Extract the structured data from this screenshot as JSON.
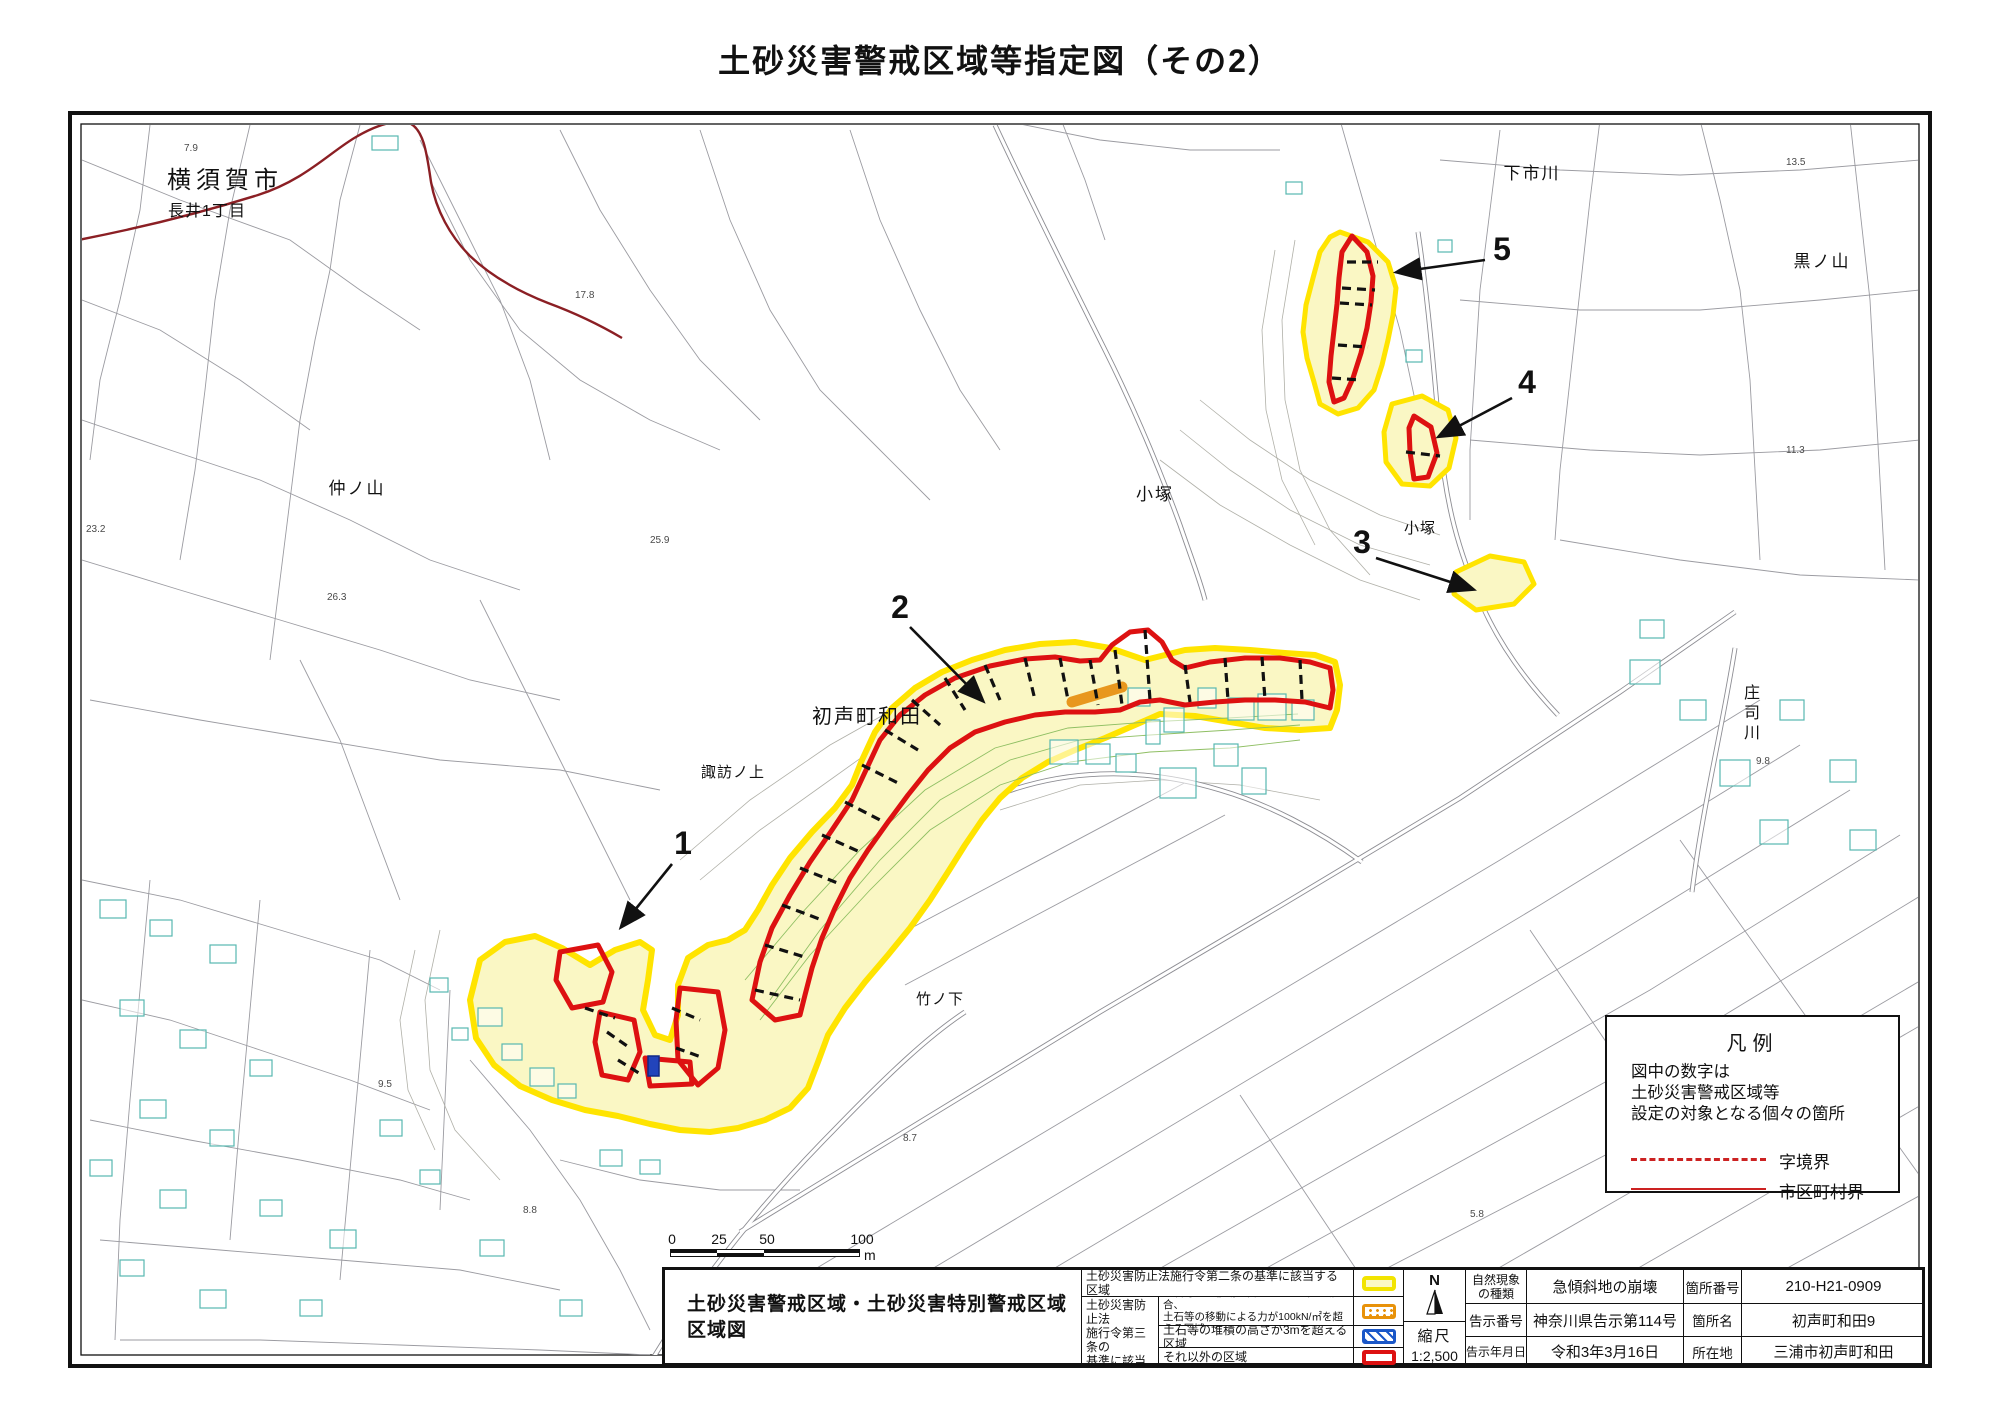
{
  "title": "土砂災害警戒区域等指定図（その2）",
  "map": {
    "labels": [
      {
        "text": "横須賀市",
        "x": 225,
        "y": 188,
        "size": 24,
        "ls": 5
      },
      {
        "text": "長井1丁目",
        "x": 207,
        "y": 216,
        "size": 16,
        "ls": 1
      },
      {
        "text": "仲ノ山",
        "x": 357,
        "y": 494,
        "size": 17,
        "ls": 2
      },
      {
        "text": "下市川",
        "x": 1532,
        "y": 179,
        "size": 17,
        "ls": 2
      },
      {
        "text": "黒ノ山",
        "x": 1822,
        "y": 267,
        "size": 17,
        "ls": 2
      },
      {
        "text": "小塚",
        "x": 1155,
        "y": 500,
        "size": 17,
        "ls": 2
      },
      {
        "text": "小塚",
        "x": 1420,
        "y": 533,
        "size": 15,
        "ls": 1
      },
      {
        "text": "庄司川",
        "x": 1752,
        "y": 698,
        "size": 16,
        "vertical": true
      },
      {
        "text": "初声町和田",
        "x": 867,
        "y": 723,
        "size": 20,
        "ls": 2
      },
      {
        "text": "諏訪ノ上",
        "x": 733,
        "y": 777,
        "size": 15,
        "ls": 1
      },
      {
        "text": "竹ノ下",
        "x": 940,
        "y": 1004,
        "size": 15,
        "ls": 1
      }
    ],
    "markers": [
      {
        "n": "1",
        "tx": 683,
        "ty": 854,
        "x1": 672,
        "y1": 864,
        "x2": 622,
        "y2": 926
      },
      {
        "n": "2",
        "tx": 900,
        "ty": 618,
        "x1": 910,
        "y1": 627,
        "x2": 982,
        "y2": 700
      },
      {
        "n": "3",
        "tx": 1362,
        "ty": 553,
        "x1": 1376,
        "y1": 558,
        "x2": 1472,
        "y2": 589
      },
      {
        "n": "4",
        "tx": 1527,
        "ty": 393,
        "x1": 1512,
        "y1": 398,
        "x2": 1440,
        "y2": 436
      },
      {
        "n": "5",
        "tx": 1502,
        "ty": 260,
        "x1": 1485,
        "y1": 260,
        "x2": 1398,
        "y2": 272
      }
    ],
    "elevations": [
      {
        "v": "7.9",
        "x": 184,
        "y": 151
      },
      {
        "v": "17.8",
        "x": 575,
        "y": 298
      },
      {
        "v": "23.2",
        "x": 86,
        "y": 532
      },
      {
        "v": "25.9",
        "x": 650,
        "y": 543
      },
      {
        "v": "26.3",
        "x": 327,
        "y": 600
      },
      {
        "v": "9.5",
        "x": 378,
        "y": 1087
      },
      {
        "v": "8.8",
        "x": 523,
        "y": 1213
      },
      {
        "v": "8.7",
        "x": 903,
        "y": 1141
      },
      {
        "v": "9.8",
        "x": 1756,
        "y": 764
      },
      {
        "v": "13.5",
        "x": 1786,
        "y": 165
      },
      {
        "v": "11.3",
        "x": 1786,
        "y": 453
      },
      {
        "v": "5.8",
        "x": 1470,
        "y": 1217
      }
    ],
    "colors": {
      "warning_zone_fill": "#faf7c4",
      "warning_zone_outline": "#ffe400",
      "special_zone_outline": "#dd1111",
      "debris_flow_force": "#e8971e",
      "debris_height": "#2244bb",
      "municipal_boundary": "#8b1f24",
      "building_outline": "#58b8b0"
    }
  },
  "legend_box": {
    "title": "凡例",
    "note_lines": [
      "図中の数字は",
      "土砂災害警戒区域等",
      "設定の対象となる個々の箇所"
    ],
    "items": [
      {
        "label": "字境界",
        "style": "dashed"
      },
      {
        "label": "市区町村界",
        "style": "solid"
      }
    ]
  },
  "scale_bar": {
    "ticks": [
      "0",
      "25",
      "50",
      "100"
    ],
    "unit": "m"
  },
  "bottom": {
    "region_title_line1": "土砂災害警戒区域・土砂災害特別警戒区域",
    "region_title_line2": "区域図",
    "legend": {
      "row1": "土砂災害防止法施行令第二条の基準に該当する区域",
      "group_lines": [
        "土砂災害防止法",
        "施行令第三条の",
        "基準に該当する",
        "区域"
      ],
      "row2_line1": "土石等の（移動）高さが1m以下の場合、",
      "row2_line2": "土石等の移動による力が100kN/㎡を超える区域",
      "row3": "土石等の堆積の高さが3mを超える区域",
      "row4": "それ以外の区域"
    },
    "compass_n": "N",
    "scale_label": "縮尺",
    "scale_value": "1:2,500",
    "info": {
      "rows": [
        {
          "l1": "自然現象の種類",
          "v1": "急傾斜地の崩壊",
          "l2": "箇所番号",
          "v2": "210-H21-0909"
        },
        {
          "l1": "告示番号",
          "v1": "神奈川県告示第114号",
          "l2": "箇所名",
          "v2": "初声町和田9"
        },
        {
          "l1": "告示年月日",
          "v1": "令和3年3月16日",
          "l2": "所在地",
          "v2": "三浦市初声町和田"
        }
      ]
    }
  }
}
